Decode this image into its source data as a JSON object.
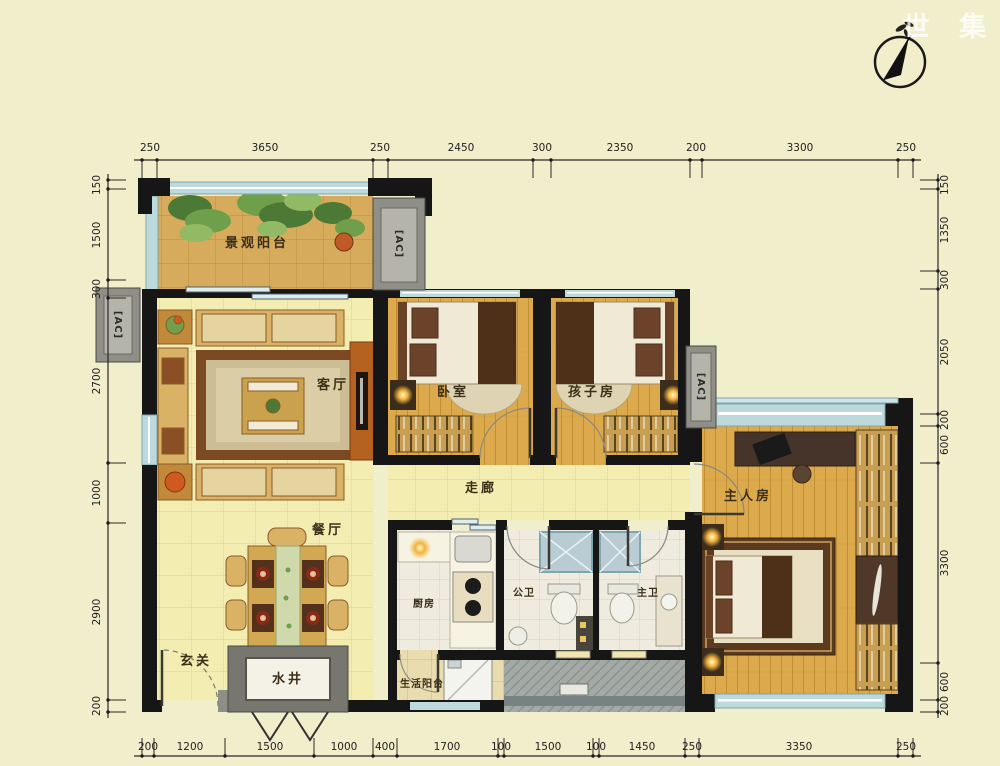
{
  "watermark": "世 集",
  "ac_label": "[AC]",
  "rooms": {
    "balcony": {
      "label": "景观阳台"
    },
    "living": {
      "label": "客厅"
    },
    "dining": {
      "label": "餐厅"
    },
    "entry": {
      "label": "玄关"
    },
    "well": {
      "label": "水井"
    },
    "bedroom": {
      "label": "卧室"
    },
    "kids": {
      "label": "孩子房"
    },
    "corridor": {
      "label": "走廊"
    },
    "kitchen": {
      "label": "厨房"
    },
    "bath_public": {
      "label": "公卫"
    },
    "bath_master": {
      "label": "主卫"
    },
    "service_balcony": {
      "label": "生活阳台"
    },
    "master": {
      "label": "主人房"
    }
  },
  "dims": {
    "top": [
      "250",
      "3650",
      "250",
      "2450",
      "300",
      "2350",
      "200",
      "3300",
      "250"
    ],
    "bottom": [
      "200",
      "1200",
      "1500",
      "1000",
      "400",
      "1700",
      "100",
      "1500",
      "100",
      "1450",
      "250",
      "3350",
      "250"
    ],
    "left": [
      "150",
      "1500",
      "300",
      "2700",
      "1000",
      "2900",
      "200"
    ],
    "right": [
      "150",
      "1350",
      "300",
      "2050",
      "200",
      "600",
      "3300",
      "600",
      "200"
    ]
  },
  "icons": {
    "compass": "north-compass-icon"
  },
  "colors": {
    "background": "#f1eecb",
    "wall": "#161616",
    "window": "#bcd9dc",
    "wood_floor": "#dda94d",
    "tile_floor": "#f3edb2",
    "balcony_floor": "#d6ab5b"
  }
}
